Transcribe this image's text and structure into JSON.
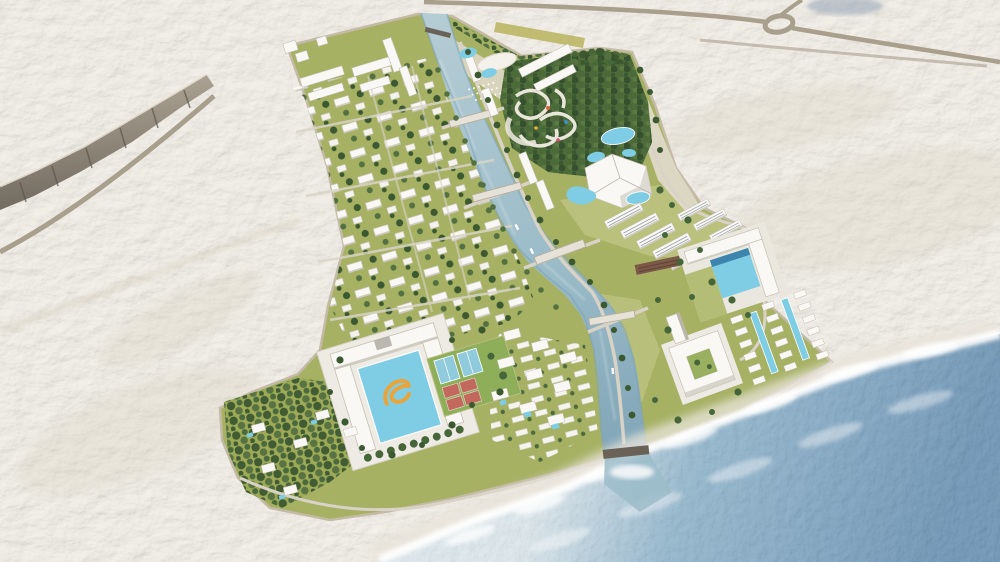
{
  "scene": {
    "type": "aerial-3d-masterplan-rendering",
    "setting": "coastal desert resort development with central canal, water park, hotels, villa districts, beach and sea"
  },
  "palette": {
    "desert": "#ebe6da",
    "desert_shadow": "#d8d0bf",
    "beach_sand": "#f4f0e7",
    "cliff": "#a89f90",
    "cliff_shadow": "#6e675c",
    "road": "#a89f8d",
    "road_minor": "#d8d3c6",
    "site_green": "#a6b164",
    "lawn_light": "#bdc380",
    "lawn_pale": "#e2dccd",
    "ground_dark": "#9dab58",
    "park_base": "#4f6a3d",
    "tree_dark": "#3c5830",
    "tree_mid": "#547040",
    "tree_light": "#46663a",
    "tree_yellow": "#b9b45e",
    "canal_light": "#b6cdd4",
    "canal_mid": "#9cbcc9",
    "canal_deep": "#7fa4b6",
    "sea_surf": "#d6e3e9",
    "sea_mid": "#7aa6c2",
    "sea_deep": "#4a7ba4",
    "foam": "#ffffff",
    "building": "#f9f8f4",
    "building_shade": "#cfccc2",
    "facade_line": "#9aa0a6",
    "pool": "#7ecde5",
    "pool_deep": "#3d85ad",
    "swirl": "#e8a53c",
    "court_red": "#c2685c",
    "court_blue": "#8fcadd",
    "court_green": "#8fae5a",
    "terrace_brown": "#7b5948",
    "weir_dark": "#6b6257",
    "slide_cream": "#f2eee3",
    "distant_blue": "#8c9bb0",
    "boat": "#ffffff"
  },
  "features": [
    "desert-terrain",
    "cliff-escarpment",
    "highway-roundabout",
    "access-roads",
    "resort-site",
    "villa-district",
    "central-canal",
    "canal-bridges",
    "canal-boats",
    "water-park",
    "entrance-plaza",
    "pentagon-building",
    "terraced-residences",
    "east-hotel-pool",
    "courtyard-hotel",
    "beach-chalets",
    "chalet-pools",
    "main-hotel",
    "main-hotel-pool",
    "swirl-logo",
    "sports-courts",
    "garden-villas",
    "beach",
    "surf-foam",
    "sea"
  ]
}
